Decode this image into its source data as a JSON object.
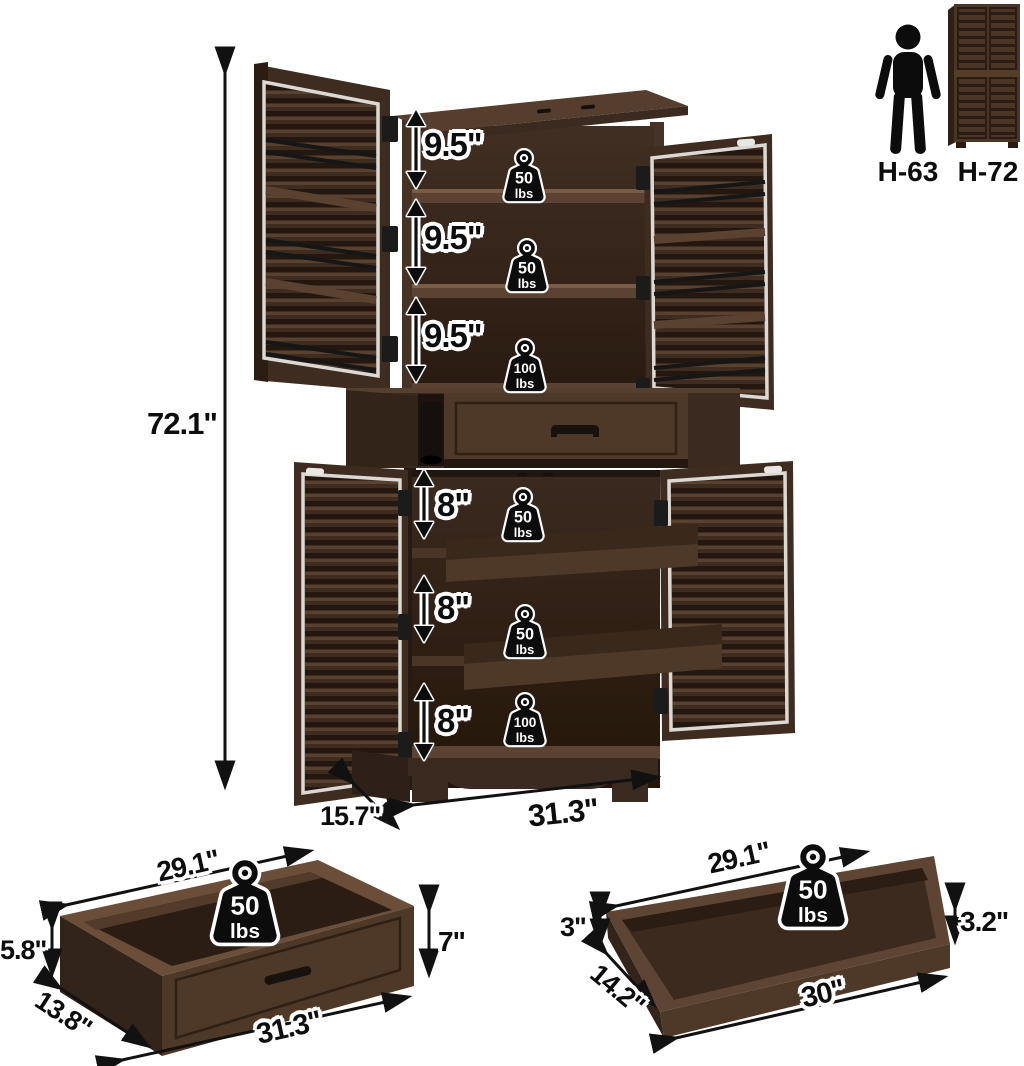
{
  "title": "pantry-cabinet-dimension-diagram",
  "colors": {
    "background": "#ffffff",
    "wood_dark": "#2a1b12",
    "wood_mid": "#3e2c21",
    "wood_light": "#6a4e3a",
    "trim_silver": "#dcd9d4",
    "label_ink": "#0d0d0d",
    "badge_black": "#0c0c0c"
  },
  "icons": {
    "person": "person-silhouette",
    "mini_cabinet": "closed-cabinet-thumbnail",
    "weight": "kettlebell-weight",
    "arrows": "double-headed-dimension-arrow"
  },
  "reference": {
    "person_label": "H-63",
    "cabinet_label": "H-72"
  },
  "cabinet": {
    "overall_height": "72.1\"",
    "width": "31.3\"",
    "depth": "15.7\"",
    "upper_sections": [
      {
        "gap": "9.5\"",
        "weight": "50",
        "unit": "lbs"
      },
      {
        "gap": "9.5\"",
        "weight": "50",
        "unit": "lbs"
      },
      {
        "gap": "9.5\"",
        "weight": "100",
        "unit": "lbs"
      }
    ],
    "lower_sections": [
      {
        "gap": "8\"",
        "weight": "50",
        "unit": "lbs"
      },
      {
        "gap": "8\"",
        "weight": "50",
        "unit": "lbs"
      },
      {
        "gap": "8\"",
        "weight": "100",
        "unit": "lbs"
      }
    ]
  },
  "drawer_detail": {
    "top_width": "29.1\"",
    "inner_height": "5.8\"",
    "depth": "13.8\"",
    "bottom_width": "31.3\"",
    "front_height": "7\"",
    "weight": "50",
    "unit": "lbs"
  },
  "tray_detail": {
    "top_width": "29.1\"",
    "left_height": "3\"",
    "depth": "14.2\"",
    "bottom_width": "30\"",
    "right_height": "3.2\"",
    "weight": "50",
    "unit": "lbs"
  }
}
